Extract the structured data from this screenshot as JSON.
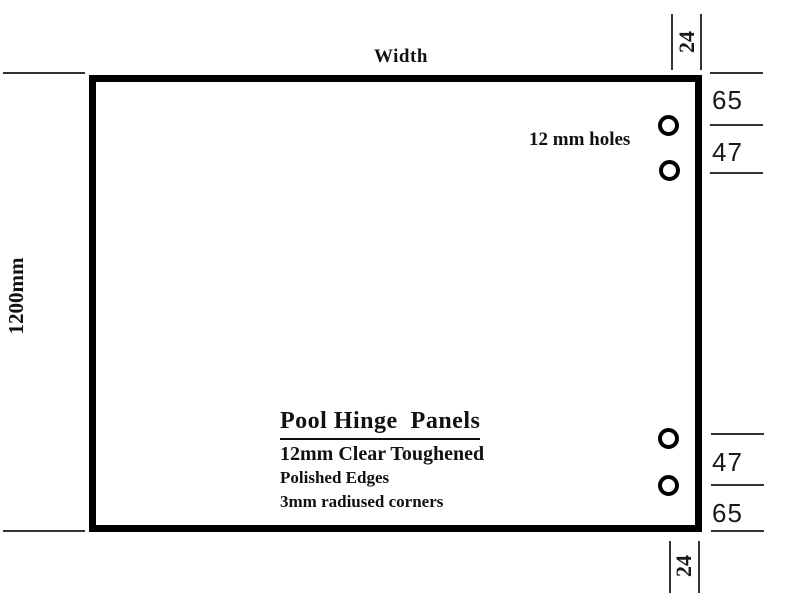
{
  "drawing": {
    "panel": {
      "width_label": "Width",
      "height_label": "1200mm"
    },
    "holes": {
      "label": "12 mm holes"
    },
    "title_block": {
      "title": "Pool Hinge  Panels",
      "specs": [
        "12mm Clear Toughened",
        "Polished Edges",
        "3mm radiused corners"
      ]
    },
    "dimensions": {
      "top_edge_offset": "24",
      "bottom_edge_offset": "24",
      "right_top": [
        "65",
        "47"
      ],
      "right_bottom": [
        "47",
        "65"
      ]
    },
    "colors": {
      "line": "#000000",
      "thin_line": "#333333",
      "text": "#111111",
      "background": "#ffffff"
    }
  }
}
